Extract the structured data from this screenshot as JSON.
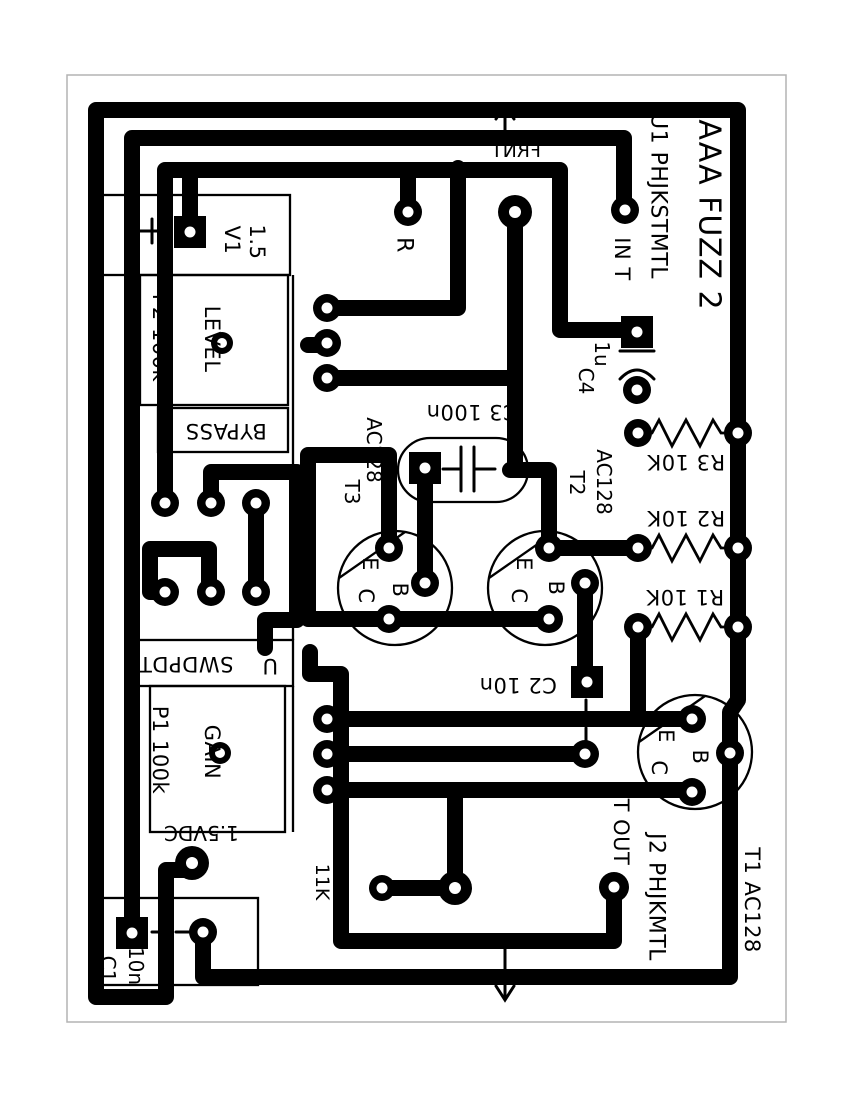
{
  "board": {
    "kind": "pcb-copper-layout",
    "colors": {
      "trace": "#000000",
      "background": "#ffffff",
      "page_border": "#b3b3b3"
    }
  },
  "texts": {
    "title": "AAA FUZZ 2",
    "u1": "U1 PHJKSTMTL",
    "in_label": "IN T",
    "r_label": "R",
    "v1": "V1",
    "v1_value": "1.5",
    "plus": "+",
    "p2": "P2 100k",
    "p2_func": "LEVEL",
    "bypass": "BYPASS",
    "swdpdt": "SWDPDT",
    "swdpdt_frag": "U",
    "p1": "P1 100k",
    "p1_func": "GAIN",
    "neg_supply": "-1.5VDC",
    "c1": "C1",
    "c1_value": "10n",
    "c2": "C2 10n",
    "c3": "C3 100n",
    "c4": "C4",
    "c4_value": "1u",
    "r1": "R1 10K",
    "r2": "R2 10K",
    "r3": "R3 10K",
    "t1": "T1 AC128",
    "t2": "T2",
    "t2_value": "AC128",
    "t3": "T3",
    "t3_value": "AC128",
    "tout": "T OUT",
    "j2": "J2 PHJKMTL",
    "frnt_top": "FRNT",
    "frnt_bottom": "FRNT",
    "frag_hidden": "11K",
    "pin_c": "C",
    "pin_e": "E",
    "pin_b": "B"
  }
}
